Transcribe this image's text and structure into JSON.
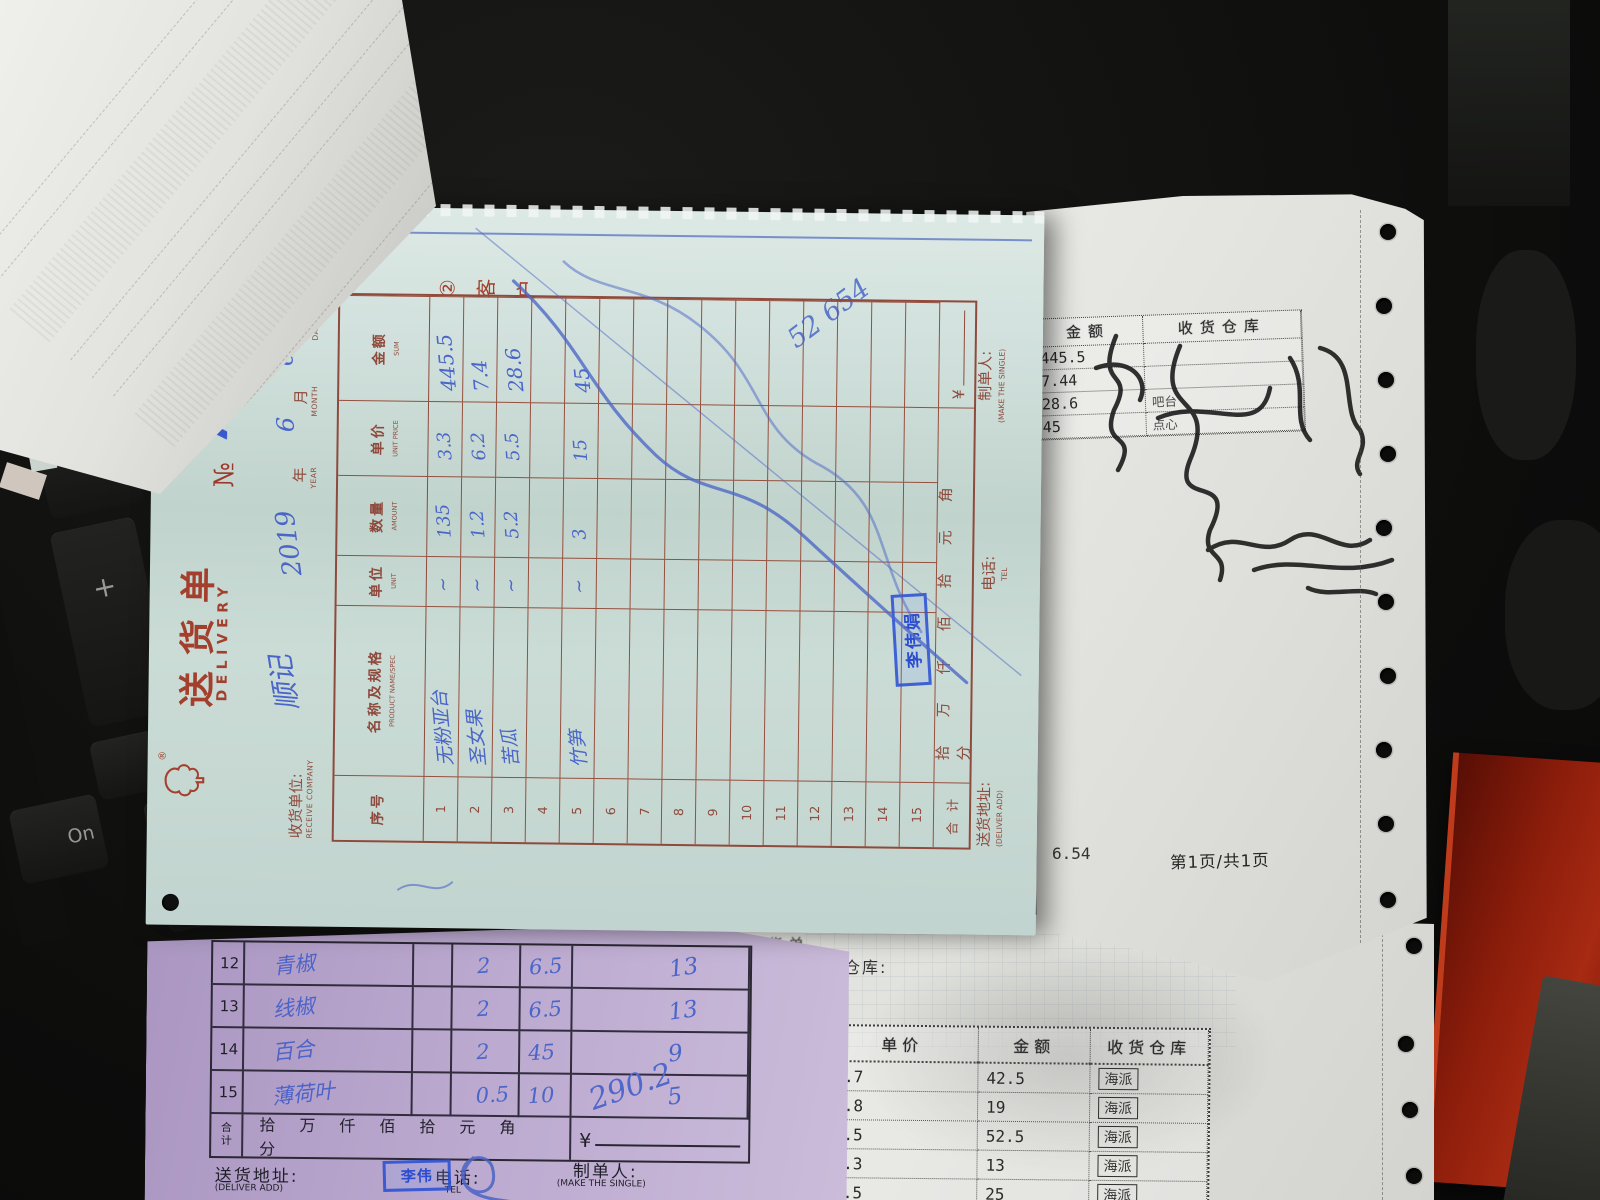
{
  "scene": {
    "keyboard": {
      "plus_key": "+",
      "enter_key": "Enter",
      "on_key": "On"
    }
  },
  "delivery_note": {
    "logo_mark": "®",
    "title_cn": "送货单",
    "title_en": "DELIVERY",
    "no_label": "№",
    "no_value": "7034",
    "copy_chars": [
      "②",
      "客",
      "户"
    ],
    "receive_company": {
      "label_cn": "收货单位:",
      "label_en": "RECEIVE COMPANY",
      "value": "顺记"
    },
    "date": {
      "year_value": "2019",
      "year_cn": "年",
      "year_en": "YEAR",
      "month_value": "6",
      "month_cn": "月",
      "month_en": "MONTH",
      "day_value": "6",
      "day_cn": "日",
      "day_en": "DAY"
    },
    "table": {
      "headers": [
        {
          "cn": "序号",
          "en": ""
        },
        {
          "cn": "名称及规格",
          "en": "PRODUCT NAME/SPEC"
        },
        {
          "cn": "单位",
          "en": "UNIT"
        },
        {
          "cn": "数量",
          "en": "AMOUNT"
        },
        {
          "cn": "单价",
          "en": "UNIT PRICE"
        },
        {
          "cn": "金额",
          "en": "SUM"
        }
      ],
      "rows": [
        {
          "no": "1",
          "name": "无粉亚台",
          "unit": "~",
          "amount": "135",
          "price": "3.3",
          "sum": "445.5"
        },
        {
          "no": "2",
          "name": "圣女果",
          "unit": "~",
          "amount": "1.2",
          "price": "6.2",
          "sum": "7.4"
        },
        {
          "no": "3",
          "name": "苦瓜",
          "unit": "~",
          "amount": "5.2",
          "price": "5.5",
          "sum": "28.6"
        },
        {
          "no": "4",
          "name": "",
          "unit": "",
          "amount": "",
          "price": "",
          "sum": ""
        },
        {
          "no": "5",
          "name": "竹笋",
          "unit": "~",
          "amount": "3",
          "price": "15",
          "sum": "45"
        },
        {
          "no": "6",
          "name": "",
          "unit": "",
          "amount": "",
          "price": "",
          "sum": ""
        },
        {
          "no": "7",
          "name": "",
          "unit": "",
          "amount": "",
          "price": "",
          "sum": ""
        },
        {
          "no": "8",
          "name": "",
          "unit": "",
          "amount": "",
          "price": "",
          "sum": ""
        },
        {
          "no": "9",
          "name": "",
          "unit": "",
          "amount": "",
          "price": "",
          "sum": ""
        },
        {
          "no": "10",
          "name": "",
          "unit": "",
          "amount": "",
          "price": "",
          "sum": ""
        },
        {
          "no": "11",
          "name": "",
          "unit": "",
          "amount": "",
          "price": "",
          "sum": ""
        },
        {
          "no": "12",
          "name": "",
          "unit": "",
          "amount": "",
          "price": "",
          "sum": ""
        },
        {
          "no": "13",
          "name": "",
          "unit": "",
          "amount": "",
          "price": "",
          "sum": ""
        },
        {
          "no": "14",
          "name": "",
          "unit": "",
          "amount": "",
          "price": "",
          "sum": ""
        },
        {
          "no": "15",
          "name": "",
          "unit": "",
          "amount": "",
          "price": "",
          "sum": ""
        }
      ],
      "total_label": "合 计",
      "total_scale": "拾万仟佰拾元角分",
      "currency": "¥"
    },
    "footer": {
      "deliver_cn": "送货地址:",
      "deliver_en": "(DELIVER ADD)",
      "tel_cn": "电话:",
      "tel_en": "TEL",
      "maker_cn": "制单人:",
      "maker_en": "(MAKE THE SINGLE)"
    },
    "stamp_text": "李伟娟",
    "margin_note": "52 654"
  },
  "top_right_receipt": {
    "headers": [
      "金额",
      "收货仓库"
    ],
    "rows": [
      {
        "sum": "445.5",
        "warehouse": ""
      },
      {
        "sum": "7.44",
        "warehouse": ""
      },
      {
        "sum": "28.6",
        "warehouse": "吧台"
      },
      {
        "sum": "45",
        "warehouse": "点心"
      }
    ],
    "signature": "楼 范海明",
    "total_fragment": "6.54",
    "page_info": "第1页/共1页"
  },
  "middle_labels": {
    "purchase_slip": "采购收货单",
    "warehouse": "仓库:"
  },
  "bottom_right_receipt": {
    "headers": [
      "单价",
      "金额",
      "收货仓库"
    ],
    "rows": [
      {
        "price": "1.7",
        "sum": "42.5",
        "warehouse": "海派"
      },
      {
        "price": "3.8",
        "sum": "19",
        "warehouse": "海派"
      },
      {
        "price": "3.5",
        "sum": "52.5",
        "warehouse": "海派"
      },
      {
        "price": "1.3",
        "sum": "13",
        "warehouse": "海派"
      },
      {
        "price": "2.5",
        "sum": "25",
        "warehouse": "海派"
      }
    ]
  },
  "purple_note": {
    "rows": [
      {
        "no": "12",
        "name": "青椒",
        "amount": "2",
        "price": "6.5",
        "sum": "13"
      },
      {
        "no": "13",
        "name": "线椒",
        "amount": "2",
        "price": "6.5",
        "sum": "13"
      },
      {
        "no": "14",
        "name": "百合",
        "amount": "2",
        "price": "45",
        "sum": "9"
      },
      {
        "no": "15",
        "name": "薄荷叶",
        "amount": "0.5",
        "price": "10",
        "sum": "5"
      }
    ],
    "total_label_1": "合",
    "total_label_2": "计",
    "total_scale": "拾万仟佰拾元角分",
    "currency": "¥",
    "total_value": "290.2",
    "footer": {
      "deliver_cn": "送货地址:",
      "deliver_en": "(DELIVER ADD)",
      "tel_cn": "电话:",
      "tel_en": "TEL",
      "maker_cn": "制单人:",
      "maker_en": "(MAKE THE SINGLE)"
    },
    "stamp_text": "李伟"
  }
}
